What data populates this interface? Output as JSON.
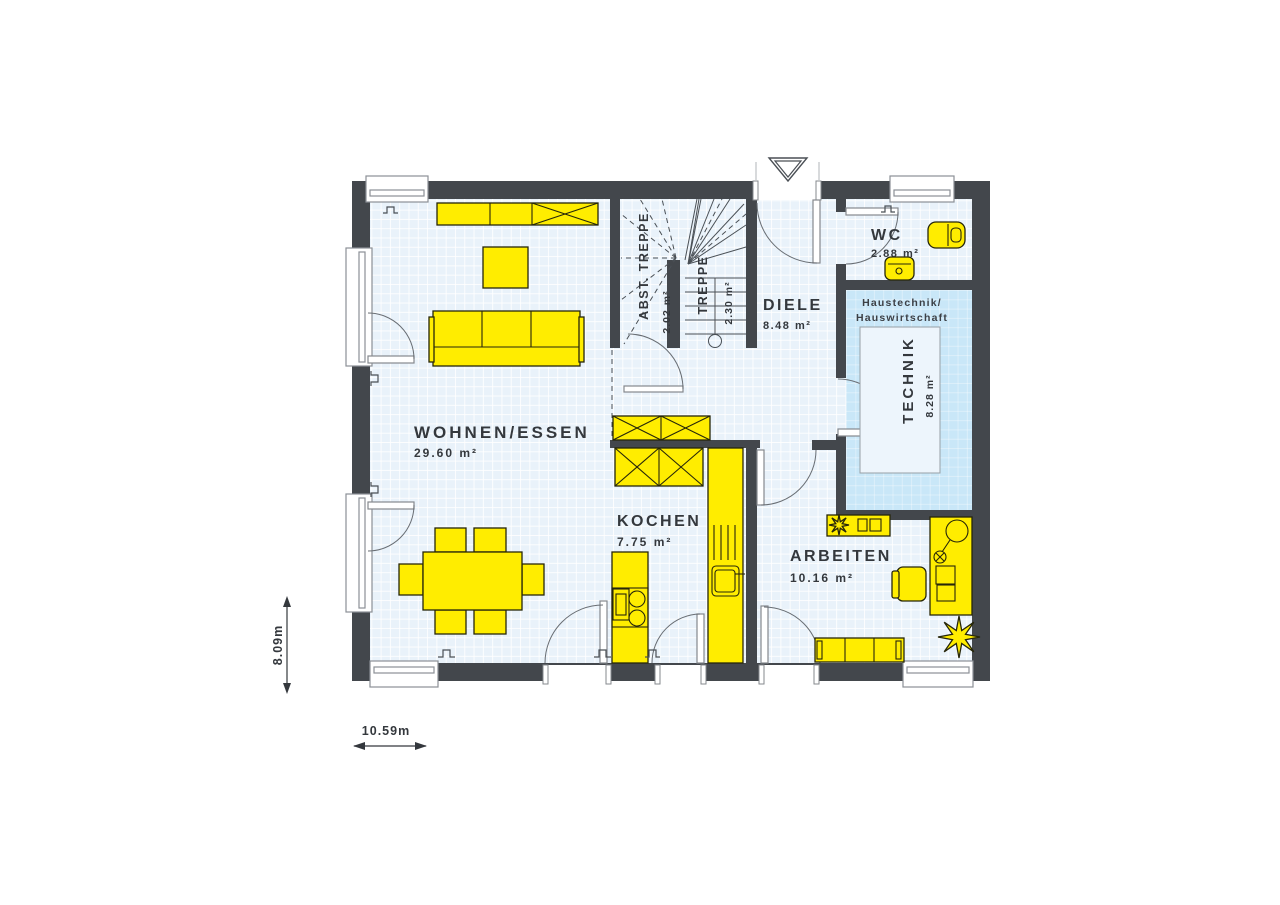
{
  "plan": {
    "rooms": {
      "wohnen_essen": {
        "name": "WOHNEN/ESSEN",
        "area": "29.60 m²"
      },
      "kochen": {
        "name": "KOCHEN",
        "area": "7.75 m²"
      },
      "diele": {
        "name": "DIELE",
        "area": "8.48 m²"
      },
      "wc": {
        "name": "WC",
        "area": "2.88 m²"
      },
      "technik": {
        "name": "TECHNIK",
        "area": "8.28 m²"
      },
      "arbeiten": {
        "name": "ARBEITEN",
        "area": "10.16 m²"
      },
      "abst_treppe": {
        "name": "ABST. TREPPE",
        "area": "2.02 m²"
      },
      "treppe": {
        "name": "TREPPE",
        "area": "2.30 m²"
      }
    },
    "notes": {
      "haustechnik": {
        "line1": "Haustechnik/",
        "line2": "Hauswirtschaft"
      }
    },
    "dimensions": {
      "height": "8.09m",
      "width": "10.59m"
    },
    "colors": {
      "wall": "#43474c",
      "floor": "#e9f2fa",
      "floor_grid": "#ffffff",
      "technik_fill": "#c9e7f8",
      "furniture": "#ffed00",
      "label_text": "#34383d"
    }
  }
}
